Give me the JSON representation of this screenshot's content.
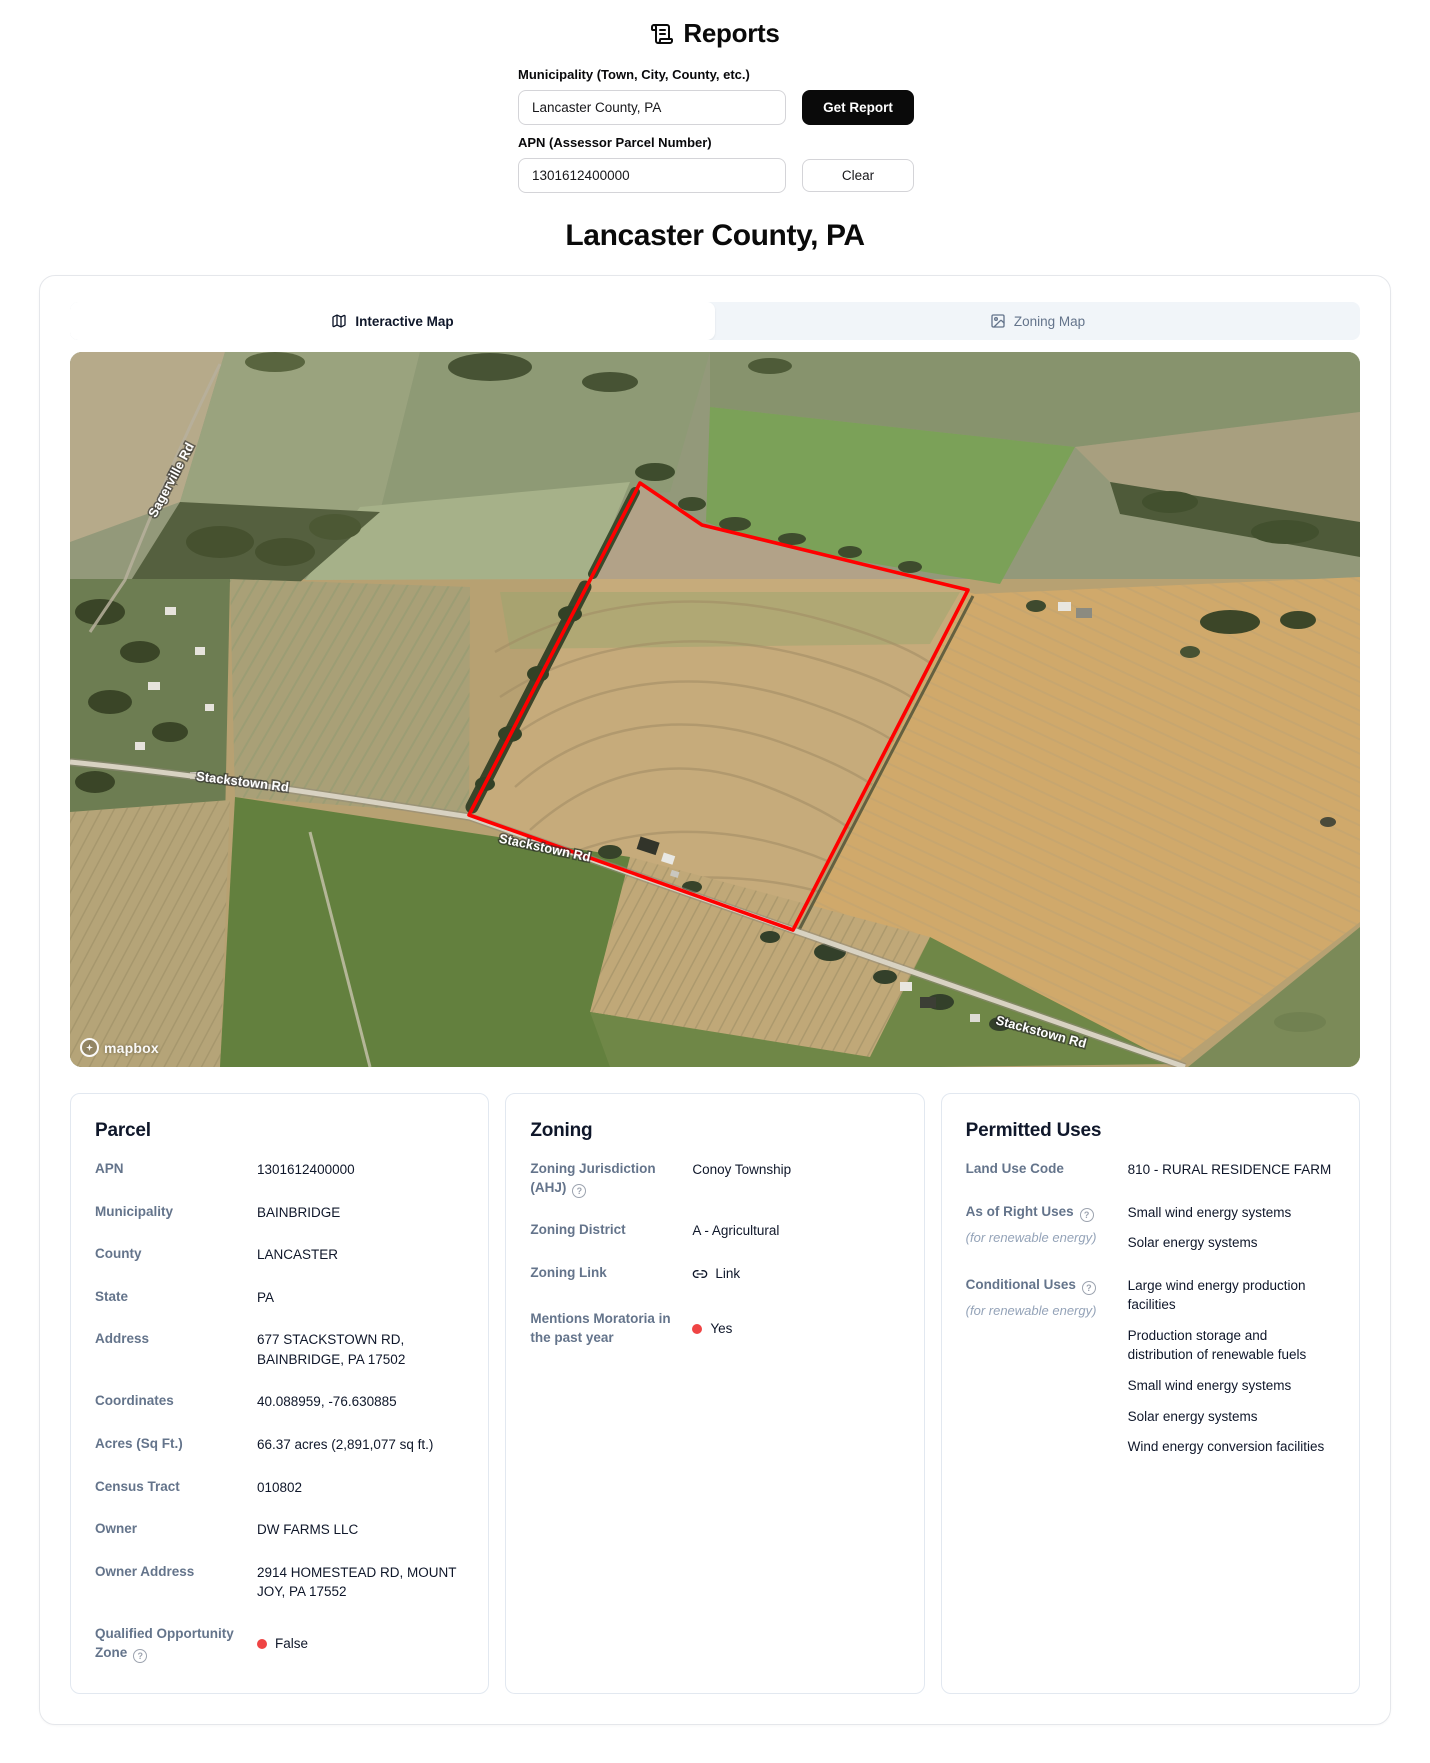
{
  "header": {
    "title": "Reports",
    "municipality_label": "Municipality (Town, City, County, etc.)",
    "municipality_value": "Lancaster County, PA",
    "get_report_label": "Get Report",
    "apn_label": "APN (Assessor Parcel Number)",
    "apn_value": "1301612400000",
    "clear_label": "Clear"
  },
  "page_title": "Lancaster County, PA",
  "tabs": {
    "interactive": "Interactive Map",
    "zoning": "Zoning Map"
  },
  "map": {
    "attribution": "mapbox",
    "parcel_outline_color": "#ff0000",
    "road_labels": [
      "Sagerville Rd",
      "Stackstown Rd",
      "Stackstown Rd",
      "Stackstown Rd"
    ]
  },
  "cards": {
    "parcel": {
      "title": "Parcel",
      "rows": [
        {
          "label": "APN",
          "value": "1301612400000"
        },
        {
          "label": "Municipality",
          "value": "BAINBRIDGE"
        },
        {
          "label": "County",
          "value": "LANCASTER"
        },
        {
          "label": "State",
          "value": "PA"
        },
        {
          "label": "Address",
          "value": "677 STACKSTOWN RD, BAINBRIDGE, PA 17502"
        },
        {
          "label": "Coordinates",
          "value": "40.088959, -76.630885"
        },
        {
          "label": "Acres (Sq Ft.)",
          "value": "66.37 acres (2,891,077 sq ft.)"
        },
        {
          "label": "Census Tract",
          "value": "010802"
        },
        {
          "label": "Owner",
          "value": "DW FARMS LLC"
        },
        {
          "label": "Owner Address",
          "value": "2914 HOMESTEAD RD, MOUNT JOY, PA 17552"
        },
        {
          "label": "Qualified Opportunity Zone",
          "value": "False",
          "status_color": "#ef4444"
        }
      ]
    },
    "zoning": {
      "title": "Zoning",
      "rows": [
        {
          "label": "Zoning Jurisdiction (AHJ)",
          "value": "Conoy Township"
        },
        {
          "label": "Zoning District",
          "value": "A - Agricultural"
        },
        {
          "label": "Zoning Link",
          "value": "Link"
        },
        {
          "label": "Mentions Moratoria in the past year",
          "value": "Yes",
          "status_color": "#ef4444"
        }
      ]
    },
    "permitted": {
      "title": "Permitted Uses",
      "rows": [
        {
          "label": "Land Use Code",
          "items": [
            "810 - RURAL RESIDENCE FARM"
          ]
        },
        {
          "label": "As of Right Uses",
          "sub": "(for renewable energy)",
          "items": [
            "Small wind energy systems",
            "Solar energy systems"
          ]
        },
        {
          "label": "Conditional Uses",
          "sub": "(for renewable energy)",
          "items": [
            "Large wind energy production facilities",
            "Production storage and distribution of renewable fuels",
            "Small wind energy systems",
            "Solar energy systems",
            "Wind energy conversion facilities"
          ]
        }
      ]
    }
  }
}
